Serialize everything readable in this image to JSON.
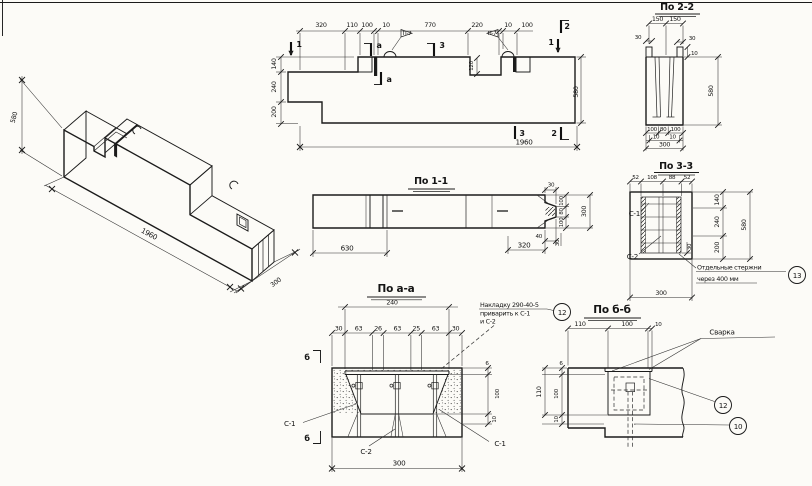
{
  "views": {
    "iso": {
      "height": "580",
      "length": "1960",
      "depth": "300"
    },
    "elev": {
      "top_dims": [
        "320",
        "110",
        "100",
        "10",
        "770",
        "220",
        "10",
        "100"
      ],
      "left_dims": [
        "140",
        "240",
        "200"
      ],
      "height_dim": "580",
      "length_dim": "1960",
      "notch_depth": "120",
      "hook_label": "П-7",
      "m1": "1",
      "m2": "2",
      "m3": "3",
      "ma": "а"
    },
    "s11": {
      "title": "По 1-1",
      "d630": "630",
      "d320": "320",
      "d40": "40",
      "d30_top": "30",
      "d30_bot": "30",
      "end_dims": [
        "100",
        "80",
        "100"
      ],
      "end_total": "300"
    },
    "s22": {
      "title": "По 2-2",
      "top_dims": [
        "150",
        "150"
      ],
      "lip_left": "30",
      "lip_right": "30",
      "lip_h": "10",
      "height_dim": "580",
      "bottom_dims": [
        "100",
        "80",
        "100"
      ],
      "edge_dims": [
        "10",
        "10"
      ],
      "width_dim": "300"
    },
    "s33": {
      "title": "По 3-3",
      "top_dims": [
        "52",
        "108",
        "88",
        "52"
      ],
      "right_dims": [
        "140",
        "240",
        "200"
      ],
      "height_dim": "580",
      "offset_dim": "30",
      "c1": "С-1",
      "c2": "С-2",
      "note1": "Отдельные стержни",
      "note2": "через 400 мм",
      "callout": "13",
      "width_dim": "300"
    },
    "saa": {
      "title": "По а-а",
      "opening_dim": "240",
      "top_dims": [
        "30",
        "63",
        "26",
        "63",
        "25",
        "63",
        "30"
      ],
      "right_dims": [
        "6",
        "100",
        "10"
      ],
      "width_dim": "300",
      "c1_left": "С-1",
      "c2": "С-2",
      "c1_right": "С-1",
      "marker": "б",
      "note1": "Накладку 290-40-5",
      "note2": "приварить к С-1",
      "note3": "и С-2",
      "callout": "12"
    },
    "sbb": {
      "title": "По б-б",
      "top_dims": [
        "110",
        "100",
        "10"
      ],
      "left_dims": [
        "6",
        "100",
        "10"
      ],
      "left_total": "110",
      "weld_label": "Сварка",
      "callout_plate": "12",
      "callout_stud": "10"
    }
  }
}
